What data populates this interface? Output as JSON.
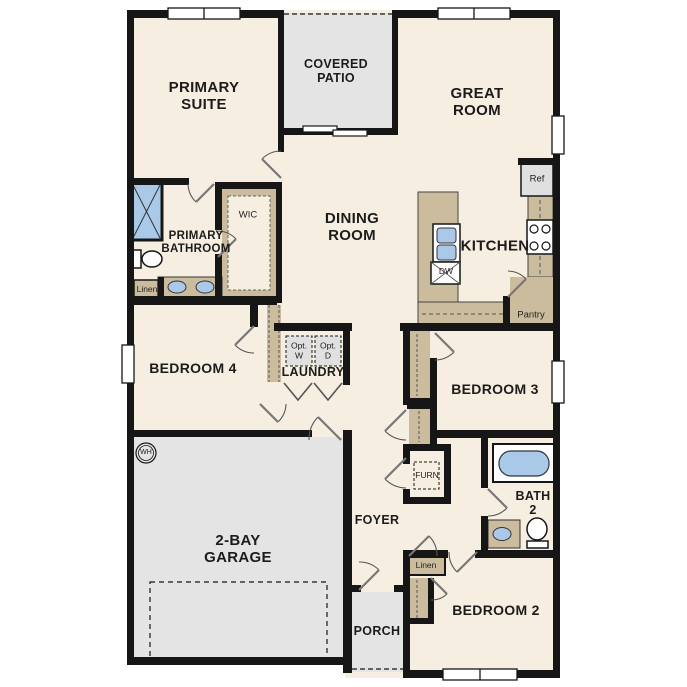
{
  "plan_title": "Single-story floor plan",
  "colors": {
    "floor": "#f6eee1",
    "outdoor_concrete": "#e4e4e4",
    "casework_tan": "#cbbc9e",
    "fixture_blue": "#aac9e9",
    "wall_black": "#161616",
    "appliance_gray": "#e0e0e0"
  },
  "labels": {
    "primary_suite": "PRIMARY\nSUITE",
    "covered_patio": "COVERED\nPATIO",
    "great_room": "GREAT\nROOM",
    "dining_room": "DINING\nROOM",
    "kitchen": "KITCHEN",
    "primary_bathroom": "PRIMARY\nBATHROOM",
    "wic": "WIC",
    "linen_bath": "Linen",
    "bedroom4": "BEDROOM 4",
    "laundry": "LAUNDRY",
    "opt_w": "Opt.\nW",
    "opt_d": "Opt.\nD",
    "pantry": "Pantry",
    "ref": "Ref",
    "dw": "DW",
    "bedroom3": "BEDROOM 3",
    "furn": "FURN",
    "foyer": "FOYER",
    "bath2": "BATH\n2",
    "wh": "WH",
    "garage": "2-BAY\nGARAGE",
    "porch": "PORCH",
    "linen_hall": "Linen",
    "bedroom2": "BEDROOM 2"
  }
}
